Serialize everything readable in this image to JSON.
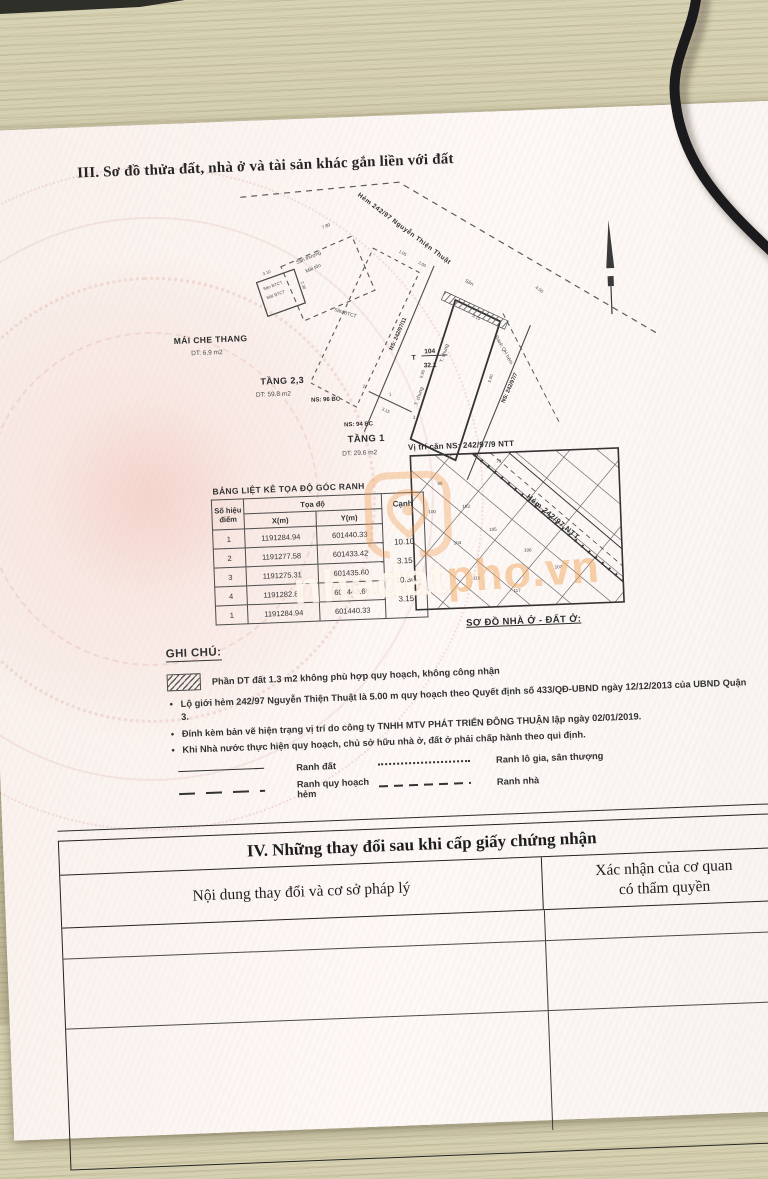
{
  "document": {
    "section3_title": "III. Sơ đồ thửa đất, nhà ở và tài sản khác gắn liền với đất",
    "section4": {
      "title": "IV. Những thay đổi sau khi cấp giấy chứng nhận",
      "col_content": "Nội dung thay đổi và cơ sở pháp lý",
      "col_confirm_line1": "Xác nhận của cơ quan",
      "col_confirm_line2": "có thẩm quyền"
    }
  },
  "diagram": {
    "alley_label": "Hẻm 242/97 Nguyễn Thiện Thuật",
    "roof_title": "MÁI CHE THANG",
    "roof_area": "DT: 6.9 m2",
    "floor23_title": "TẦNG 2,3",
    "floor23_area": "DT: 59.8 m2",
    "floor1_title": "TẦNG 1",
    "floor1_area": "DT: 29.6 m2",
    "ns_96": "NS: 96 BC",
    "ns_94": "NS: 94 BC",
    "ns_alley11": "NS: 242/97/11",
    "ns_alley7": "NS: 242/97/7",
    "plot_t": "T",
    "plot_number": "104",
    "plot_area": "32.1",
    "t_chung_1": "T. chung",
    "t_chung_2": "T. chung",
    "ranh_qh_hem": "Ranh QH hẻm",
    "san": "Sân",
    "san_thuong": "Sân thượng",
    "mai_ton": "Mái tôn",
    "san_btct_roof": "Sân BTCT",
    "mai_btct": "Mái BTCT",
    "san_btct_mid": "Sân BTCT",
    "dims": {
      "d780": "7.80",
      "d310": "3.10",
      "d230": "2.30",
      "d105": "1.05",
      "d200": "2.00",
      "d400": "4.00",
      "d315a": "3.15",
      "d315b": "3.15",
      "d315c": "3.15",
      "d590a": "5.90",
      "d590b": "5.90"
    },
    "points": {
      "p2": "2",
      "p1": "1",
      "p3": "3"
    }
  },
  "coord_table": {
    "title": "BẢNG LIỆT KÊ TỌA ĐỘ GÓC RANH",
    "col_point_l1": "Số hiệu",
    "col_point_l2": "điểm",
    "col_coord": "Tọa độ",
    "col_x": "X(m)",
    "col_y": "Y(m)",
    "col_edge": "Cạnh",
    "rows": [
      {
        "p": "1",
        "x": "1191284.94",
        "y": "601440.33"
      },
      {
        "p": "2",
        "x": "1191277.58",
        "y": "601433.42"
      },
      {
        "p": "3",
        "x": "1191275.31",
        "y": "601435.60"
      },
      {
        "p": "4",
        "x": "1191282.81",
        "y": "601442.66"
      },
      {
        "p": "1",
        "x": "1191284.94",
        "y": "601440.33"
      }
    ],
    "edges": [
      "10.10",
      "3.15",
      "10.30",
      "3.15"
    ]
  },
  "inset_map": {
    "title": "Vị trí căn NS: 242/97/9 NTT",
    "alley_label": "Hẻm 242/97 NTT",
    "caption": "SƠ ĐỒ NHÀ Ở - ĐẤT Ở:",
    "parcel_numbers": [
      "71",
      "99",
      "100",
      "103",
      "104",
      "105",
      "106",
      "107",
      "116",
      "117"
    ]
  },
  "notes": {
    "title": "GHI CHÚ:",
    "hatch_note": "Phần DT đất 1.3 m2 không phù hợp quy hoạch, không công nhận",
    "bullets": [
      "Lộ giới hẻm 242/97 Nguyễn Thiện Thuật là 5.00 m quy hoạch theo Quyết định số 433/QĐ-UBND ngày 12/12/2013 của UBND Quận 3.",
      "Đính kèm bản vẽ hiện trạng vị trí do công ty TNHH MTV PHÁT TRIỂN ĐÔNG THUẬN lập ngày 02/01/2019.",
      "Khi Nhà nước thực hiện quy hoạch, chủ sở hữu nhà ở, đất ở phải chấp hành theo qui định."
    ],
    "legend": [
      {
        "label": "Ranh đất"
      },
      {
        "label": "Ranh lô gia, sân thượng"
      },
      {
        "label": "Ranh quy hoạch hẻm"
      },
      {
        "label": "Ranh nhà"
      }
    ]
  },
  "watermark": {
    "part1": "nhadat",
    "part2": "pho.vn"
  },
  "colors": {
    "paper": "#fbf6f3",
    "ink": "#333333",
    "emblem_pink": "#e8b7ac",
    "watermark_orange": "#f0a14f",
    "desk_wood": "#cdc6a4"
  }
}
